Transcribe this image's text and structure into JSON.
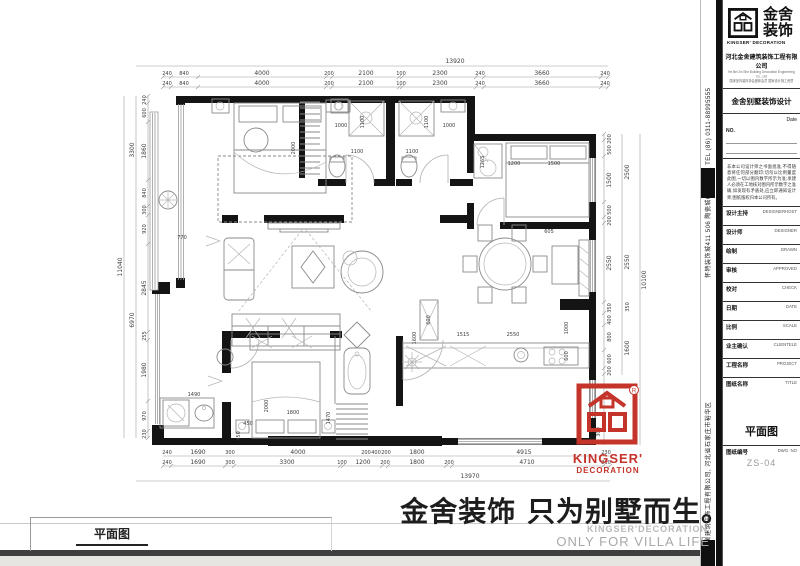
{
  "colors": {
    "accent_red": "#c4342b",
    "wall_black": "#141414"
  },
  "dims": {
    "top_total": "13920",
    "top1": [
      "240",
      "840",
      "4000",
      "200",
      "2100",
      "100",
      "2300",
      "240",
      "3660",
      "240"
    ],
    "top2": [
      "240",
      "840",
      "4000",
      "200",
      "2100",
      "100",
      "2300",
      "240",
      "3660",
      "240"
    ],
    "bot1": [
      "240",
      "1690",
      "300",
      "4000",
      "200",
      "400",
      "200",
      "1800",
      "4915",
      "230"
    ],
    "bot2": [
      "240",
      "1690",
      "300",
      "3300",
      "100",
      "1200",
      "200",
      "1800",
      "200",
      "4710",
      "230"
    ],
    "bot_total": "13970",
    "left_inner": [
      "240",
      "600",
      "1860",
      "840",
      "300",
      "920",
      "2845",
      "255",
      "1980",
      "970",
      "230"
    ],
    "left_mid": [
      "3300",
      "6970"
    ],
    "left_total": "11040",
    "right_inner": [
      "200",
      "500",
      "1500",
      "500",
      "200",
      "2550",
      "350",
      "400",
      "800",
      "600",
      "200"
    ],
    "right_mid": [
      "2500",
      "2550",
      "350",
      "1600"
    ],
    "right_total": "10100",
    "right_extra": "300",
    "interior": {
      "i1": "2000",
      "i2": "1000",
      "i3": "1100",
      "i4": "1100",
      "i5": "1100",
      "i6": "1100",
      "i7": "1000",
      "i8": "1265",
      "i9": "1200",
      "i10": "1500",
      "i11": "605",
      "i12": "770",
      "i13": "600",
      "i14": "1600",
      "i15": "1515",
      "i16": "2550",
      "i17": "1000",
      "i18": "600",
      "i19": "1490",
      "i20": "450",
      "i21": "450",
      "i22": "2000",
      "i23": "1800",
      "i24": "1470"
    }
  },
  "red_logo": {
    "en_top": "KINGSER'",
    "en_bottom": "DECORATION"
  },
  "slogan": {
    "cn": "金舍装饰 只为别墅而生。",
    "en_small": "KINGSER'DECORATION",
    "en_large": "ONLY FOR VILLA LIFE"
  },
  "footer": {
    "plan_label": "平面图"
  },
  "strip": {
    "text_upper": "怀特装饰城411 506 陶瓷城6楼  石家庄 TEL (86) 0311-88995555",
    "text_lower": "河北金舍建筑装饰工程有限公司, 河北省石家庄市裕华区"
  },
  "titleblock": {
    "brand_cn_top": "金舍",
    "brand_cn_bottom": "装饰",
    "brand_en": "KINGSER' DECORATION",
    "company": "河北金舍建筑装饰工程有限公司",
    "company_en": "He Bei Jin She Building Decoration Engineering Co., Ltd",
    "company_sub": "国家室内装饰协会团体会员 国家设计施工资质",
    "product": "金舍别墅装饰设计",
    "date_label": "Date",
    "no_label": "NO.",
    "disclaimer": "非本公司设计师之书面批准,不得随意将任何部分翻印;切勿以比例量度此图,一切以图内数字所示为准;承建人必须在工地核对图内所示数字之准确,如发现有矛盾处,应立即通知设计师;图纸版权归本公司所有。",
    "rows": [
      {
        "label": "设计主持",
        "value": "DESIGNERHOST"
      },
      {
        "label": "设计师",
        "value": "DESIGNER"
      },
      {
        "label": "绘制",
        "value": "DRAWN"
      },
      {
        "label": "审核",
        "value": "APPROVED"
      },
      {
        "label": "校对",
        "value": "CHECK"
      },
      {
        "label": "日期",
        "value": "DATE"
      },
      {
        "label": "比例",
        "value": "SCALE"
      },
      {
        "label": "业主确认",
        "value": "CLIENTELE"
      },
      {
        "label": "工程名称",
        "value": "PROJECT"
      },
      {
        "label": "图纸名称",
        "value": "TITLE"
      },
      {
        "label": "图纸编号",
        "value": "DWG. NO"
      }
    ],
    "drawing_title": "平面图",
    "drawing_no": "ZS-04"
  }
}
